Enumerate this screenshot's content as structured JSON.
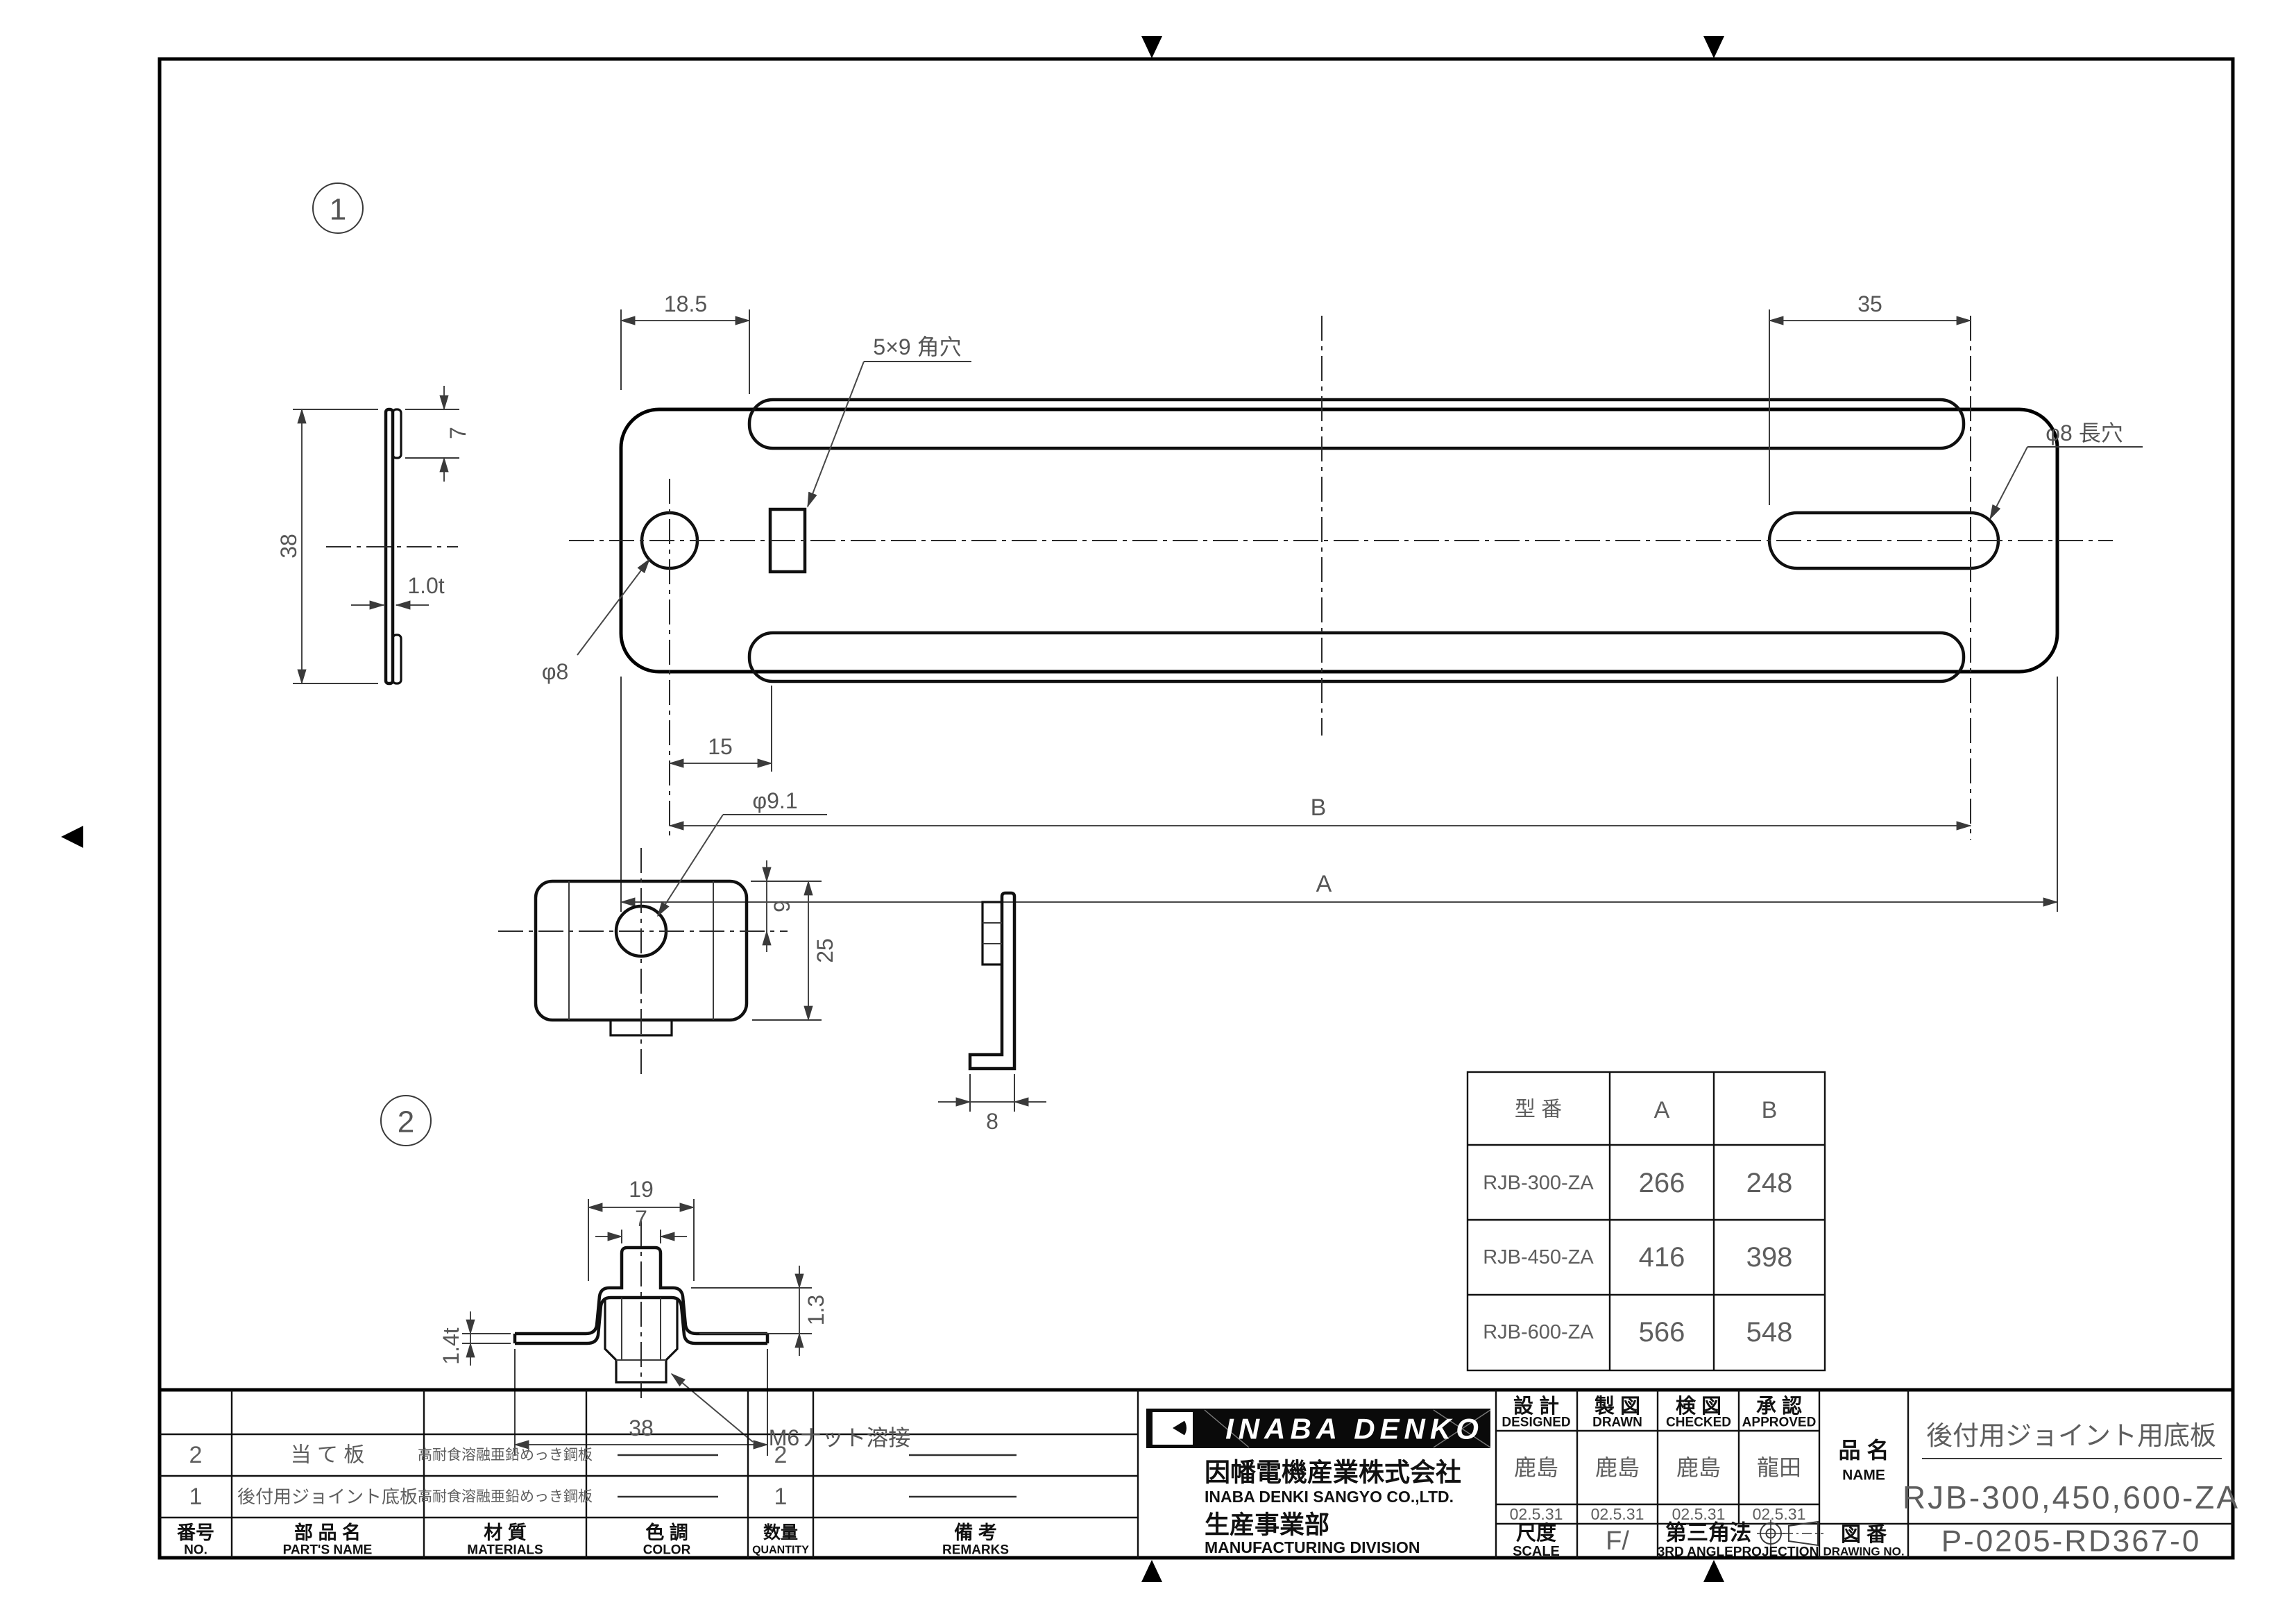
{
  "part1": {
    "balloon": "1",
    "dim_offset_left": "18.5",
    "label_square_hole": "5×9 角穴",
    "dim_slot_length": "35",
    "label_slot": "φ8 長穴",
    "label_round_hole": "φ8",
    "dim_hole_pitch": "15",
    "dim_B": "B",
    "dim_A": "A",
    "dim_hem": "7",
    "dim_width": "38",
    "dim_thickness": "1.0t"
  },
  "part2": {
    "balloon": "2",
    "label_hole": "φ9.1",
    "dim_hole_offset": "9",
    "dim_height": "25",
    "dim_depth": "8",
    "dim_boss_width": "19",
    "dim_tab_width": "7",
    "dim_rise": "1.3",
    "dim_thickness": "1.4t",
    "dim_width": "38",
    "label_nut": "M6ナット溶接"
  },
  "model_table": {
    "headers": [
      "型  番",
      "A",
      "B"
    ],
    "rows": [
      [
        "RJB-300-ZA",
        "266",
        "248"
      ],
      [
        "RJB-450-ZA",
        "416",
        "398"
      ],
      [
        "RJB-600-ZA",
        "566",
        "548"
      ]
    ]
  },
  "parts_table": {
    "headers_jp": [
      "番号",
      "部 品 名",
      "材  質",
      "色  調",
      "数量",
      "備  考"
    ],
    "headers_en": [
      "NO.",
      "PART'S NAME",
      "MATERIALS",
      "COLOR",
      "QUANTITY",
      "REMARKS"
    ],
    "rows": [
      {
        "no": "2",
        "name": "当  て  板",
        "material": "高耐食溶融亜鉛めっき鋼板",
        "color": "—",
        "qty": "2",
        "remarks": "—"
      },
      {
        "no": "1",
        "name": "後付用ジョイント底板",
        "material": "高耐食溶融亜鉛めっき鋼板",
        "color": "—",
        "qty": "1",
        "remarks": "—"
      }
    ]
  },
  "title_block": {
    "logo_text": "INABA DENKO",
    "company_jp": "因幡電機産業株式会社",
    "company_en": "INABA DENKI SANGYO CO.,LTD.",
    "division_jp": "生産事業部",
    "division_en": "MANUFACTURING DIVISION",
    "sign_cols": [
      {
        "jp": "設 計",
        "en": "DESIGNED",
        "name": "鹿島",
        "date": "02.5.31"
      },
      {
        "jp": "製 図",
        "en": "DRAWN",
        "name": "鹿島",
        "date": "02.5.31"
      },
      {
        "jp": "検 図",
        "en": "CHECKED",
        "name": "鹿島",
        "date": "02.5.31"
      },
      {
        "jp": "承 認",
        "en": "APPROVED",
        "name": "龍田",
        "date": "02.5.31"
      }
    ],
    "name_label_jp": "品 名",
    "name_label_en": "NAME",
    "product_name": "後付用ジョイント用底板",
    "product_code": "RJB-300,450,600-ZA",
    "scale_label_jp": "尺度",
    "scale_label_en": "SCALE",
    "scale_value": "F/",
    "projection_jp": "第三角法",
    "projection_en": "3RD ANGLEPROJECTION",
    "drawing_no_label_jp": "図 番",
    "drawing_no_label_en": "DRAWING NO.",
    "drawing_no": "P-0205-RD367-0"
  }
}
